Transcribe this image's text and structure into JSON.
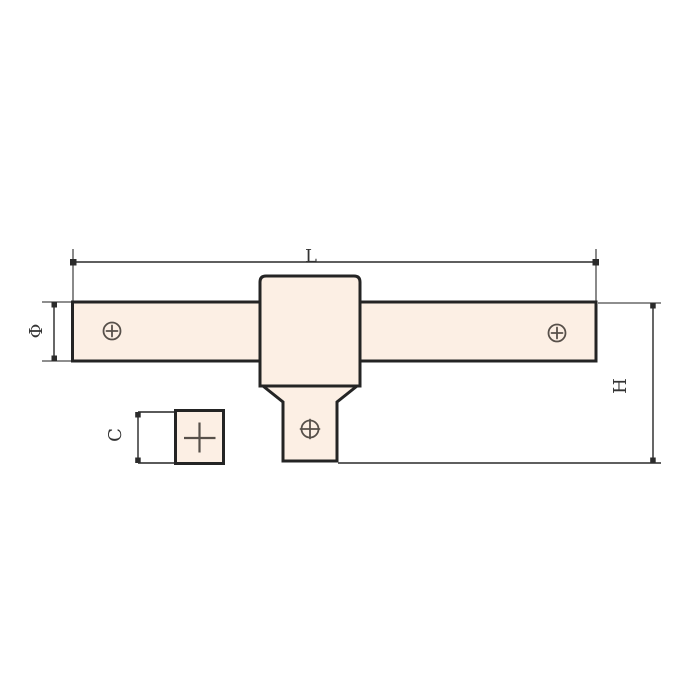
{
  "drawing": {
    "type": "technical-drawing",
    "labels": {
      "length": "L",
      "diameter": "Φ",
      "height": "H",
      "drive_size": "C"
    },
    "icons": {
      "handle_screw": "circle-cross-screw-icon",
      "drive_screw": "circle-cross-screw-icon",
      "drive_end_marking": "plus-cross-icon"
    },
    "colors": {
      "background": "#ffffff",
      "part_fill": "#fcefe4",
      "part_outline": "#242424",
      "dimension_line": "#5f5f5f",
      "extension_line": "#4a4a4a",
      "marker": "#2b2b2b",
      "screw_stroke": "#57504a",
      "label_text": "#333333"
    }
  }
}
